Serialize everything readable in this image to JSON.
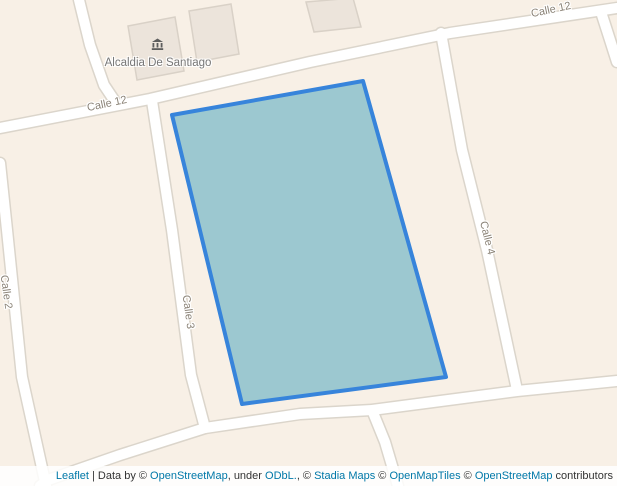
{
  "map": {
    "background_color": "#f8f0e6",
    "poi": {
      "label": "Alcaldia De Santiago",
      "icon": "town-hall-icon"
    },
    "street_labels": [
      {
        "name": "Calle 12"
      },
      {
        "name": "Calle 12"
      },
      {
        "name": "Calle 2"
      },
      {
        "name": "Calle 3"
      },
      {
        "name": "Calle 4"
      }
    ],
    "polygon": {
      "fill_color": "#9cc8d0",
      "stroke_color": "#3784db",
      "stroke_width": "4",
      "points_attr": "172,115 363,81 446,377 242,404"
    }
  },
  "attribution": {
    "segments": [
      {
        "text": "Leaflet",
        "link": true
      },
      {
        "text": " | Data by © ",
        "link": false
      },
      {
        "text": "OpenStreetMap",
        "link": true
      },
      {
        "text": ", under ",
        "link": false
      },
      {
        "text": "ODbL.",
        "link": true
      },
      {
        "text": ", © ",
        "link": false
      },
      {
        "text": "Stadia Maps",
        "link": true
      },
      {
        "text": " © ",
        "link": false
      },
      {
        "text": "OpenMapTiles",
        "link": true
      },
      {
        "text": " © ",
        "link": false
      },
      {
        "text": "OpenStreetMap",
        "link": true
      },
      {
        "text": " contributors",
        "link": false
      }
    ]
  }
}
